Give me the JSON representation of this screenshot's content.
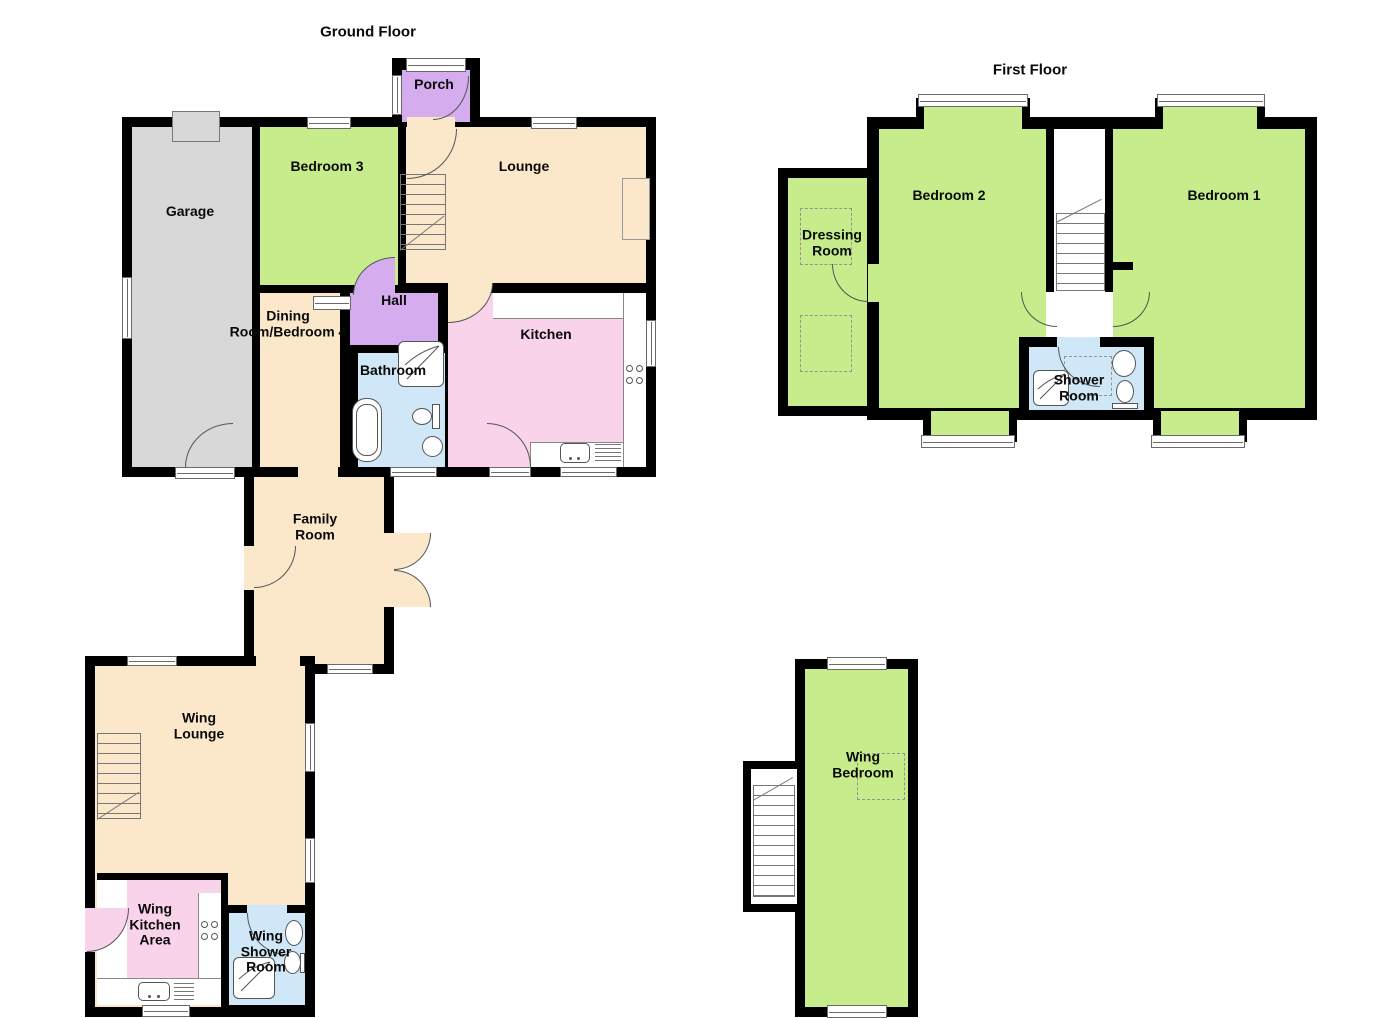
{
  "titles": {
    "ground": "Ground Floor",
    "first": "First Floor"
  },
  "rooms": {
    "porch": "Porch",
    "garage": "Garage",
    "bedroom3": "Bedroom 3",
    "lounge": "Lounge",
    "hall": "Hall",
    "dining": "Dining\nRoom/Bedroom 4",
    "bathroom": "Bathroom",
    "kitchen": "Kitchen",
    "family": "Family\nRoom",
    "wing_lounge": "Wing\nLounge",
    "wing_kitchen": "Wing\nKitchen\nArea",
    "wing_shower": "Wing\nShower\nRoom",
    "bedroom2": "Bedroom 2",
    "bedroom1": "Bedroom 1",
    "dressing": "Dressing\nRoom",
    "shower_room": "Shower\nRoom",
    "wing_bedroom": "Wing\nBedroom"
  },
  "colors": {
    "green": "#c6ec8b",
    "cream": "#fbe7ca",
    "pink": "#f9d3e9",
    "purple": "#d5adee",
    "blue": "#cfe7f6",
    "gray": "#d8d8d8",
    "wall": "#000000"
  }
}
